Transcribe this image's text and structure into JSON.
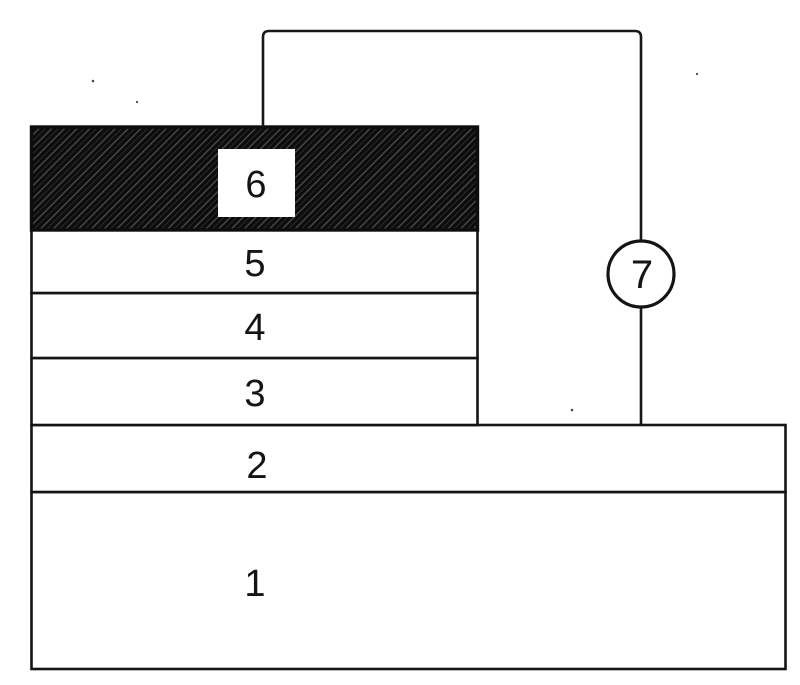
{
  "figure": {
    "layers": [
      {
        "id": "layer-1",
        "label": "1"
      },
      {
        "id": "layer-2",
        "label": "2"
      },
      {
        "id": "layer-3",
        "label": "3"
      },
      {
        "id": "layer-4",
        "label": "4"
      },
      {
        "id": "layer-5",
        "label": "5"
      },
      {
        "id": "layer-6",
        "label": "6"
      }
    ],
    "node": {
      "label": "7"
    }
  },
  "colors": {
    "ink": "#141414",
    "paper": "#ffffff",
    "electrode_fill": "#0c0c0c",
    "hatch_streak": "#4f4f4f",
    "hatch_streak_faint": "#2e2e2e"
  }
}
